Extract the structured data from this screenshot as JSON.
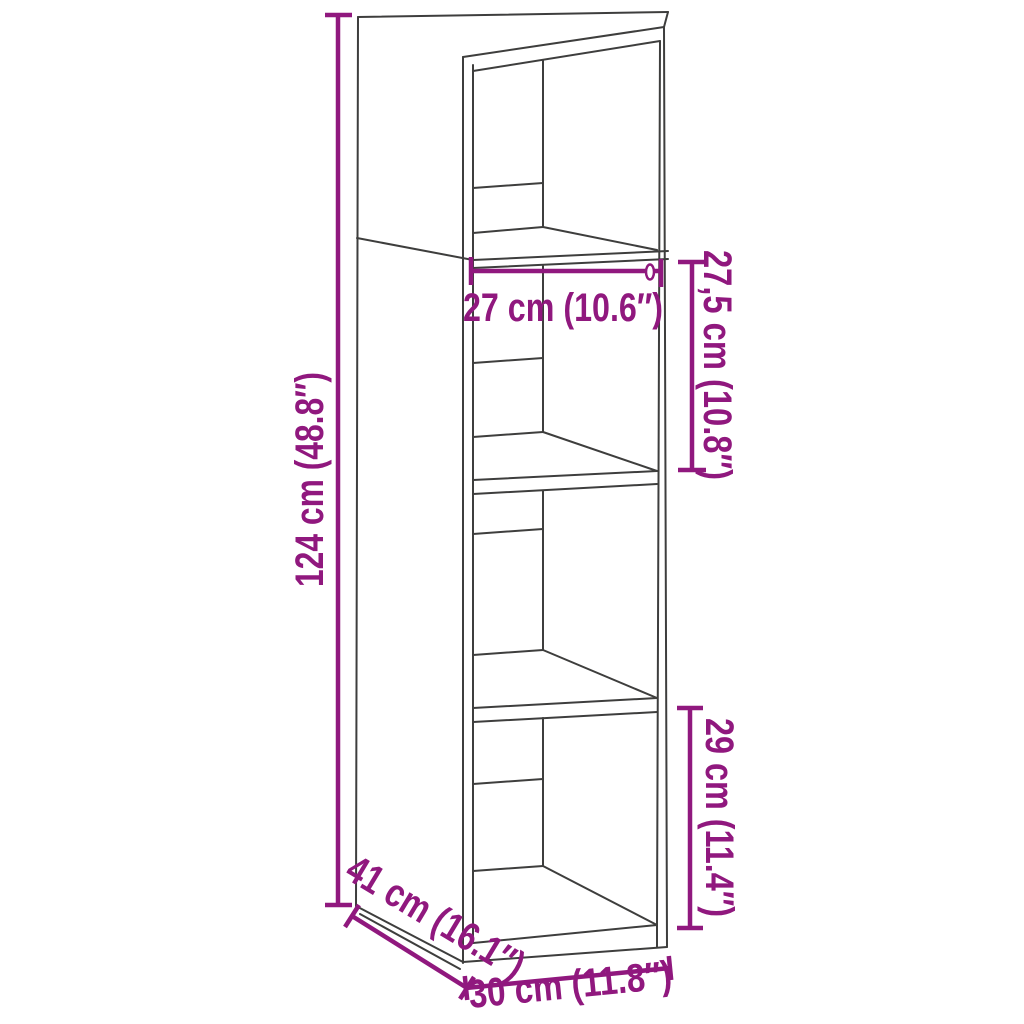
{
  "diagram": {
    "kind": "furniture-dimension-line-drawing",
    "product": "tall-narrow-cabinet-with-shelves",
    "background_color": "#ffffff",
    "drawing_line_color": "#3E3E3D",
    "dimension_color": "#90187E",
    "labels": {
      "height": "124 cm (48.8″)",
      "inner_width": "27 cm (10.6″)",
      "upper_inner_height": "27,5 cm (10.8″)",
      "lower_inner_height": "29 cm (11.4″)",
      "depth": "41 cm (16.1″)",
      "width": "30 cm (11.8″)"
    }
  }
}
